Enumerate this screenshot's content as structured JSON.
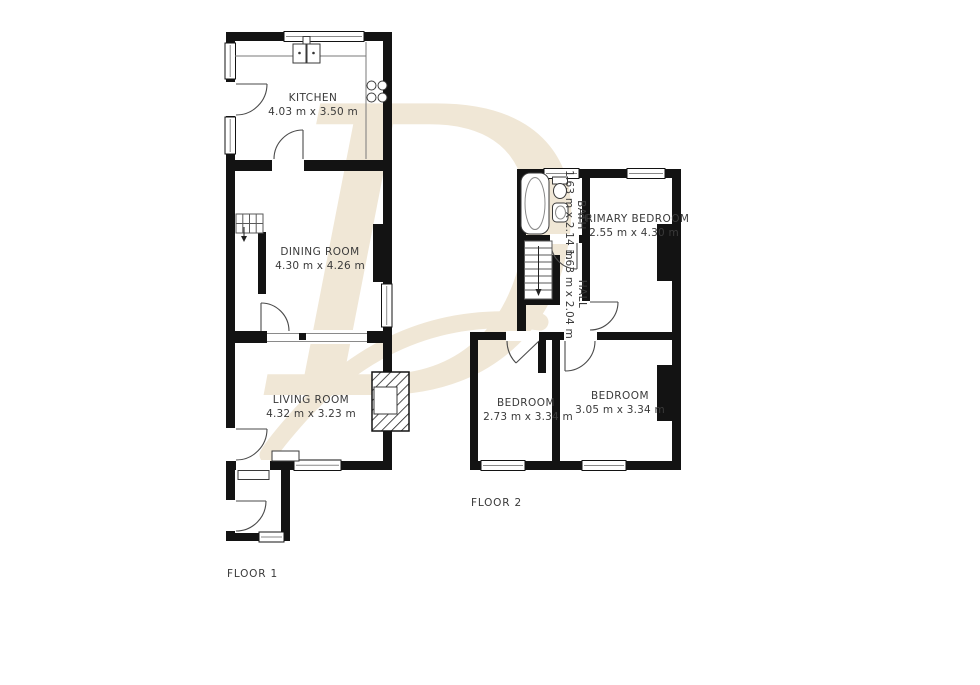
{
  "watermark": {
    "letter": "D",
    "color": "#f0e7d6"
  },
  "colors": {
    "wall": "#131313",
    "label_text": "#3a3a3a",
    "background": "#ffffff"
  },
  "floor1": {
    "label": "FLOOR 1",
    "rooms": [
      {
        "name": "KITCHEN",
        "dims": "4.03 m x 3.50 m"
      },
      {
        "name": "DINING ROOM",
        "dims": "4.30 m x 4.26 m"
      },
      {
        "name": "LIVING ROOM",
        "dims": "4.32 m x 3.23 m"
      }
    ]
  },
  "floor2": {
    "label": "FLOOR 2",
    "rooms": [
      {
        "name": "BATH",
        "dims": "1.63 m x 2.14 m"
      },
      {
        "name": "HALL",
        "dims": "1.63 m x 2.04 m"
      },
      {
        "name": "PRIMARY BEDROOM",
        "dims": "2.55 m x 4.30 m"
      },
      {
        "name": "BEDROOM",
        "dims": "2.73 m x 3.34 m"
      },
      {
        "name": "BEDROOM",
        "dims": "3.05 m x 3.34 m"
      }
    ]
  }
}
